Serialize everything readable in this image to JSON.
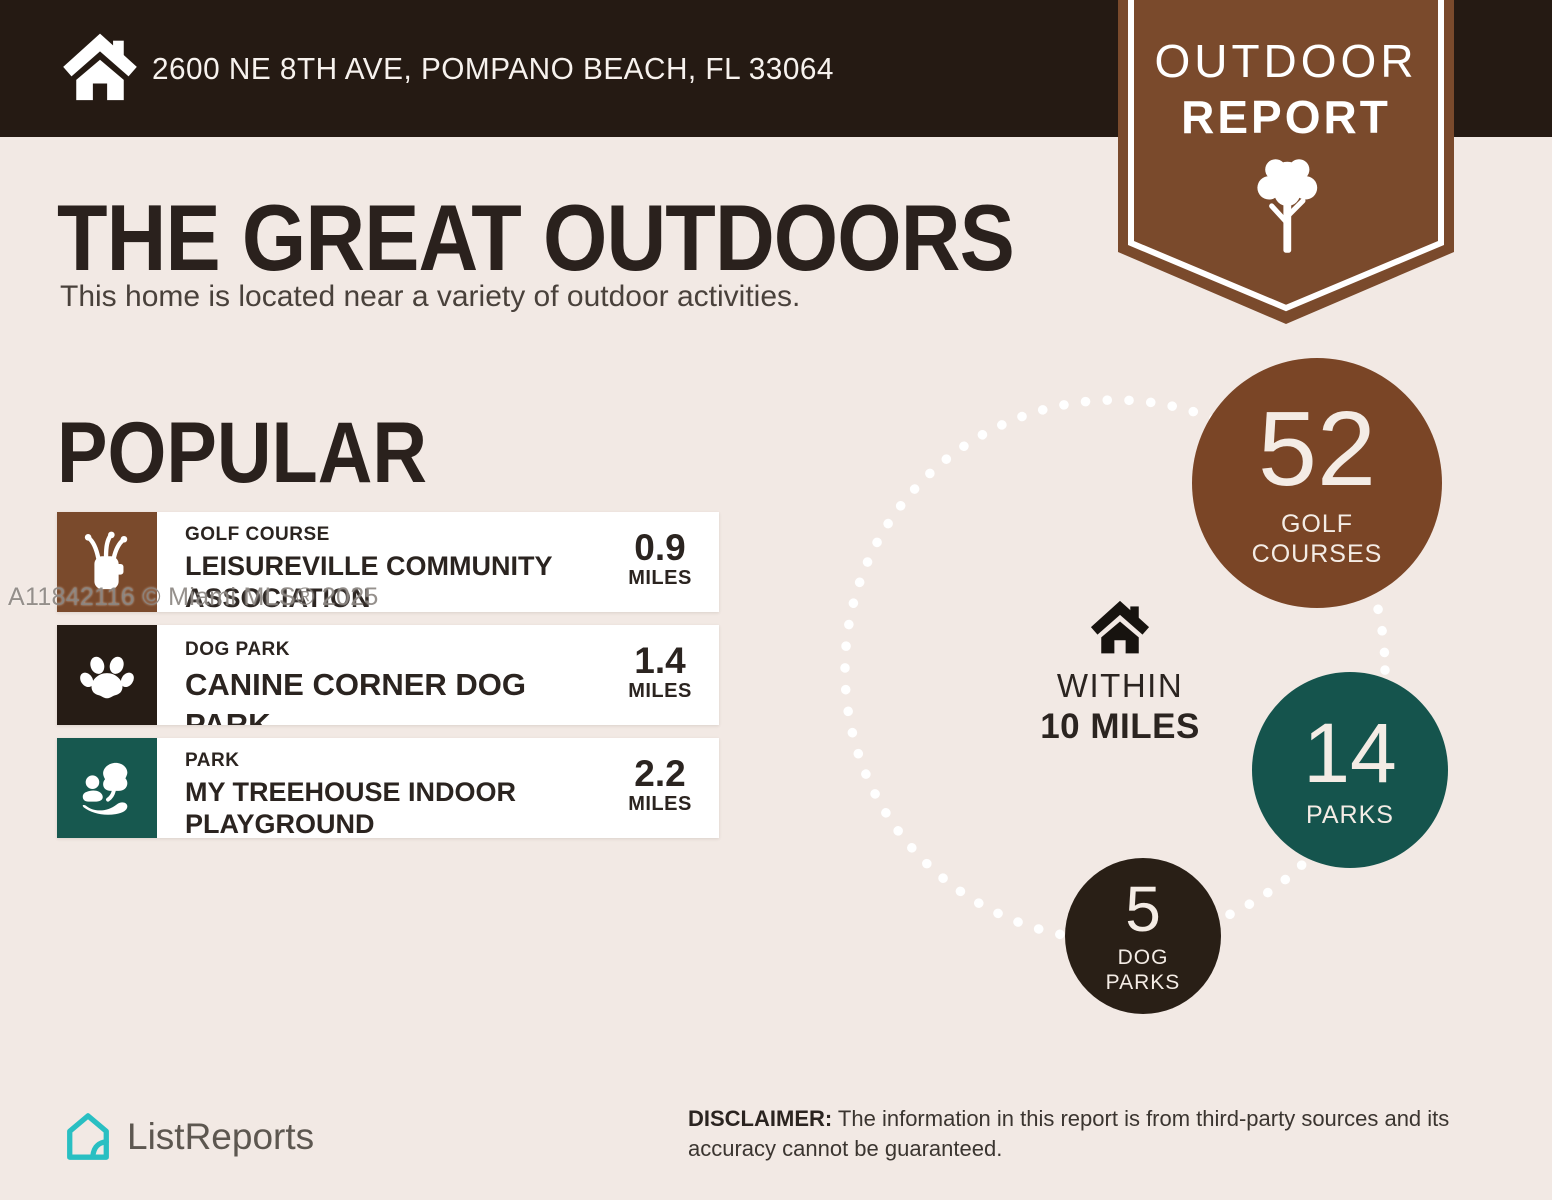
{
  "colors": {
    "background": "#f2e9e4",
    "topbar_dark_brown": "#251a13",
    "ribbon_brown": "#7a4a2c",
    "golf_circle_brown": "#7a4526",
    "parks_teal": "#15544d",
    "dog_circle_dark": "#291f16",
    "row_background": "#ffffff",
    "logo_teal": "#29bfc2",
    "text_dark": "#2a211d"
  },
  "header": {
    "address": "2600 NE 8TH AVE, POMPANO BEACH, FL 33064"
  },
  "ribbon": {
    "line1": "OUTDOOR",
    "line2": "REPORT"
  },
  "intro": {
    "title": "THE GREAT OUTDOORS",
    "subtitle": "This home is located near a variety of outdoor activities."
  },
  "popular": {
    "heading": "POPULAR",
    "items": [
      {
        "category": "GOLF COURSE",
        "name": "LEISUREVILLE COMMUNITY ASSOCIATION",
        "distance": "0.9",
        "unit": "MILES"
      },
      {
        "category": "DOG PARK",
        "name": "CANINE CORNER DOG PARK",
        "distance": "1.4",
        "unit": "MILES"
      },
      {
        "category": "PARK",
        "name": "MY TREEHOUSE INDOOR PLAYGROUND",
        "distance": "2.2",
        "unit": "MILES"
      }
    ]
  },
  "radius": {
    "line1": "WITHIN",
    "line2": "10 MILES"
  },
  "stats": [
    {
      "value": "52",
      "label1": "GOLF",
      "label2": "COURSES"
    },
    {
      "value": "14",
      "label1": "PARKS",
      "label2": ""
    },
    {
      "value": "5",
      "label1": "DOG",
      "label2": "PARKS"
    }
  ],
  "watermark": "A11842116 © Miami MLS® 2025",
  "footer": {
    "brand": "ListReports",
    "disclaimer_label": "DISCLAIMER:",
    "disclaimer_text": " The information in this report is from third-party sources and its accuracy cannot be guaranteed."
  }
}
